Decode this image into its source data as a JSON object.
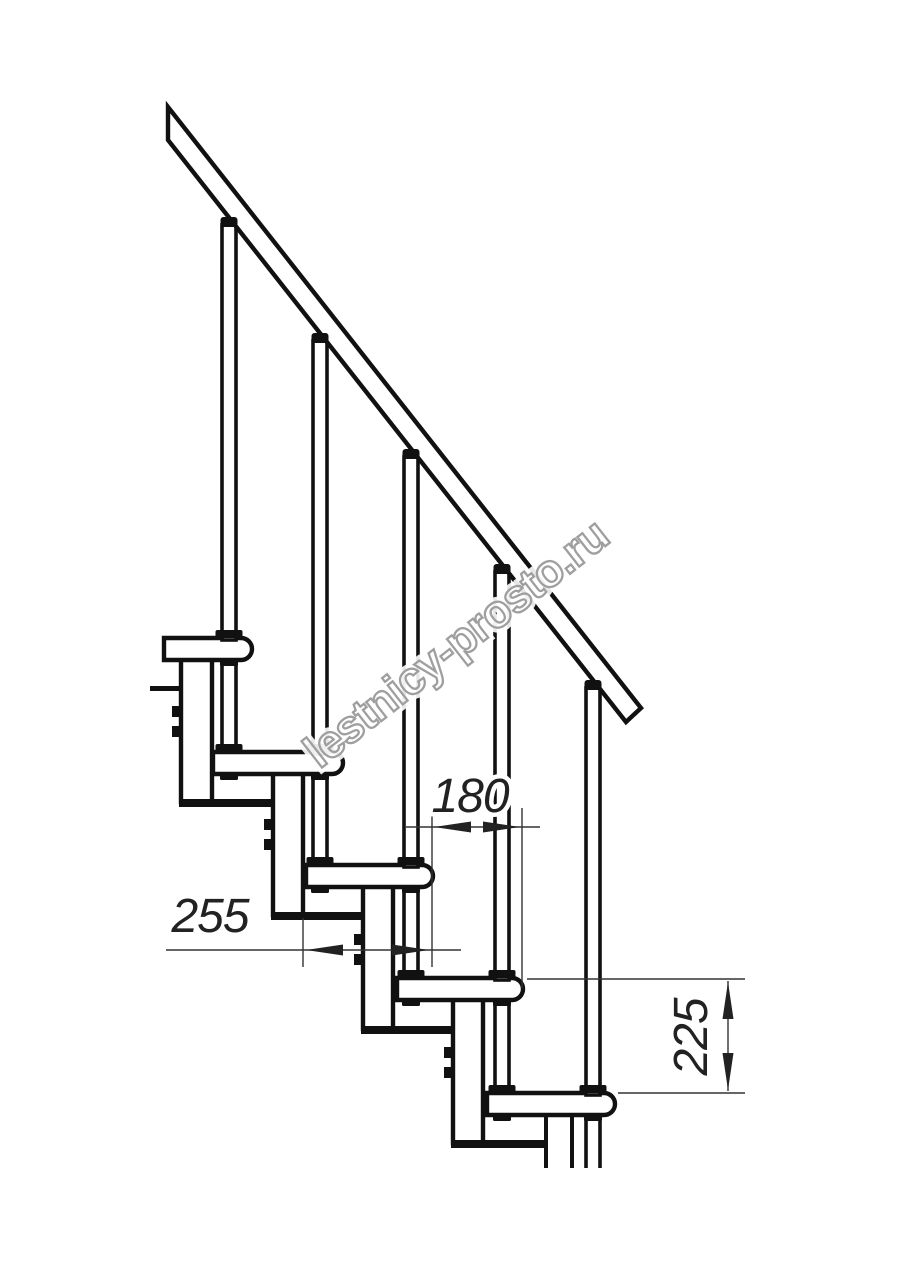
{
  "dimensions": {
    "tread_depth": "255",
    "step_run": "180",
    "riser_height": "225"
  },
  "watermark": {
    "text": "lestnicy-prosto.ru"
  },
  "components": {
    "handrail_count": 1,
    "baluster_count": 5,
    "tread_count": 5,
    "support_column_count": 5
  },
  "style": {
    "line_color": "#111111",
    "dimension_color": "#333333",
    "watermark_outline_color": "#9f9f9f",
    "background_color": "#ffffff"
  }
}
